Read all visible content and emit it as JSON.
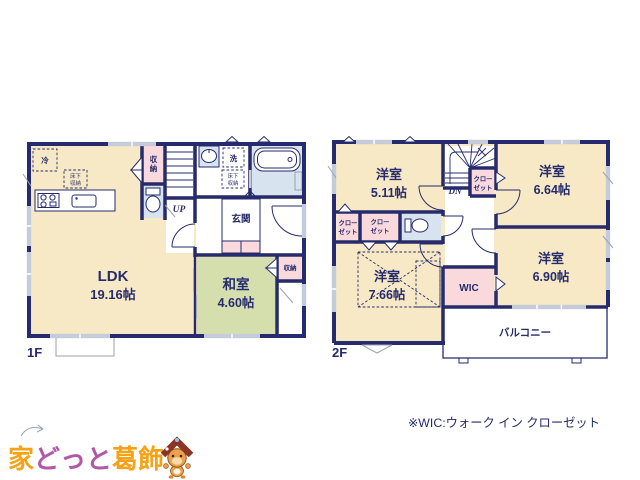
{
  "palette": {
    "wall_navy": "#262b6d",
    "room_cream": "#f7e9c5",
    "tatami_green": "#d5dfae",
    "closet_pink": "#f9d9db",
    "wet_blue": "#d7e4f0",
    "window_gray": "#c5cbd8",
    "logo_orange": "#f5a216",
    "logo_purple": "#b158a8",
    "mascot_roof": "#8c3526"
  },
  "floor1": {
    "label": "1F",
    "ldk_name": "LDK",
    "ldk_area": "19.16帖",
    "washitsu_name": "和室",
    "washitsu_area": "4.60帖",
    "genkan": "玄関",
    "storage_hall": [
      "収",
      "納"
    ],
    "storage_washitsu": "収納",
    "fridge": "冷",
    "laundry": "洗",
    "underfloor_kitchen": [
      "床下",
      "収納"
    ],
    "underfloor_wash": [
      "床下",
      "収納"
    ],
    "stairs": "UP"
  },
  "floor2": {
    "label": "2F",
    "room_a_name": "洋室",
    "room_a_area": "5.11帖",
    "room_b_name": "洋室",
    "room_b_area": "6.64帖",
    "room_c_name": "洋室",
    "room_c_area": "7.66帖",
    "room_d_name": "洋室",
    "room_d_area": "6.90帖",
    "wic": "WIC",
    "balcony": "バルコニー",
    "stairs": "DN",
    "closet_hall": [
      "クロー",
      "ゼット"
    ],
    "closet_left_a": [
      "クロー",
      "ゼット"
    ],
    "closet_left_b": [
      "クロー",
      "ゼット"
    ]
  },
  "footer": {
    "wic_note": "※WIC:ウォーク イン クローゼット"
  },
  "logo": {
    "part_ie": "家",
    "part_dotto": "どっと",
    "part_katsushika": "葛飾"
  }
}
